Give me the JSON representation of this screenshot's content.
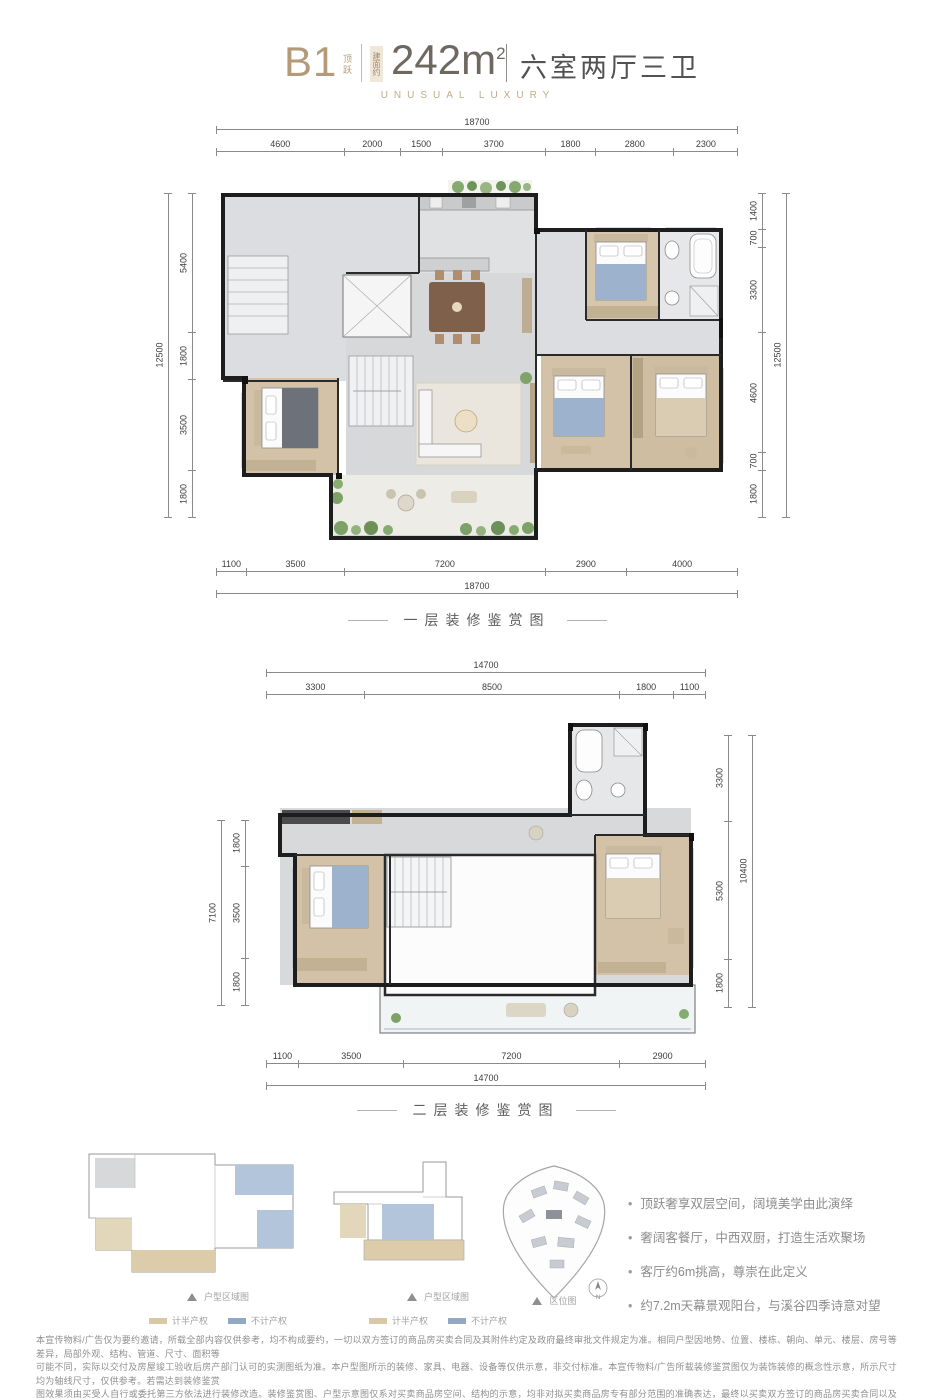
{
  "header": {
    "unit": "B1",
    "unit_tag": "顶跃",
    "area_badge": "建面约",
    "area_value": "242m",
    "area_sup": "2",
    "layout_text": "六室两厅三卫",
    "tagline": "UNUSUAL LUXURY"
  },
  "floor1": {
    "caption": "一层装修鉴赏图",
    "dims": {
      "top_total": 18700,
      "top_segments": [
        4600,
        2000,
        1500,
        3700,
        1800,
        2800,
        2300
      ],
      "bottom_total": 18700,
      "bottom_segments": [
        1100,
        3500,
        7200,
        2900,
        4000
      ],
      "left_total": 12500,
      "left_segments": [
        5400,
        1800,
        3500,
        1800
      ],
      "right_total": 12500,
      "right_segments": [
        1400,
        700,
        3300,
        4600,
        700,
        1800
      ]
    }
  },
  "floor2": {
    "caption": "二层装修鉴赏图",
    "dims": {
      "top_total": 14700,
      "top_segments": [
        3300,
        8500,
        1800,
        1100
      ],
      "bottom_total": 14700,
      "bottom_segments": [
        1100,
        3500,
        7200,
        2900
      ],
      "left_total": 7100,
      "left_segments": [
        1800,
        3500,
        1800
      ],
      "right_total": 10400,
      "right_segments": [
        3300,
        5300,
        1800
      ]
    }
  },
  "thumbnails": {
    "plan1_label": "户型区域图",
    "plan2_label": "户型区域图",
    "site_label": "区位图",
    "north_label": "N",
    "legend": [
      {
        "label": "计半产权",
        "color": "#d9c8a5"
      },
      {
        "label": "不计产权",
        "color": "#92a9c5"
      }
    ]
  },
  "highlights": [
    "顶跃奢享双层空间，阔境美学由此演绎",
    "奢阔客餐厅，中西双厨，打造生活欢聚场",
    "客厅约6m挑高，尊崇在此定义",
    "约7.2m天幕景观阳台，与溪谷四季诗意对望"
  ],
  "disclaimer": [
    "本宣传物料/广告仅为要约邀请，所载全部内容仅供参考，均不构成要约，一切以双方签订的商品房买卖合同及其附件约定及政府最终审批文件规定为准。相同户型因地势、位置、楼栋、朝向、单元、楼层、房号等差异，局部外观、结构、管道、尺寸、面积等",
    "可能不同，实际以交付及房屋竣工验收后房产部门认可的实测图纸为准。本户型图所示的装修、家具、电器、设备等仅供示意，非交付标准。本宣传物料/广告所载装修鉴赏图仅为装饰装修的概念性示意，所示尺寸均为轴线尺寸，仅供参考。若需达到装修鉴赏",
    "图效果须由买受人自行或委托第三方依法进行装修改造。装修鉴赏图、户型示意图仅系对买卖商品房空间、结构的示意，均非对拟买卖商品房专有部分范围的准确表达，最终以买卖双方签订的商品房买卖合同以及合同约定附图为准。项目推广案名：黄龙溪谷·",
    "沁云湾。政府核准备案名：黄龙溪谷西五期。开发商：眉山优联房地产开发有限公司。预售证号：2020房预售证第139号。制作日期：2022年6月。"
  ]
}
